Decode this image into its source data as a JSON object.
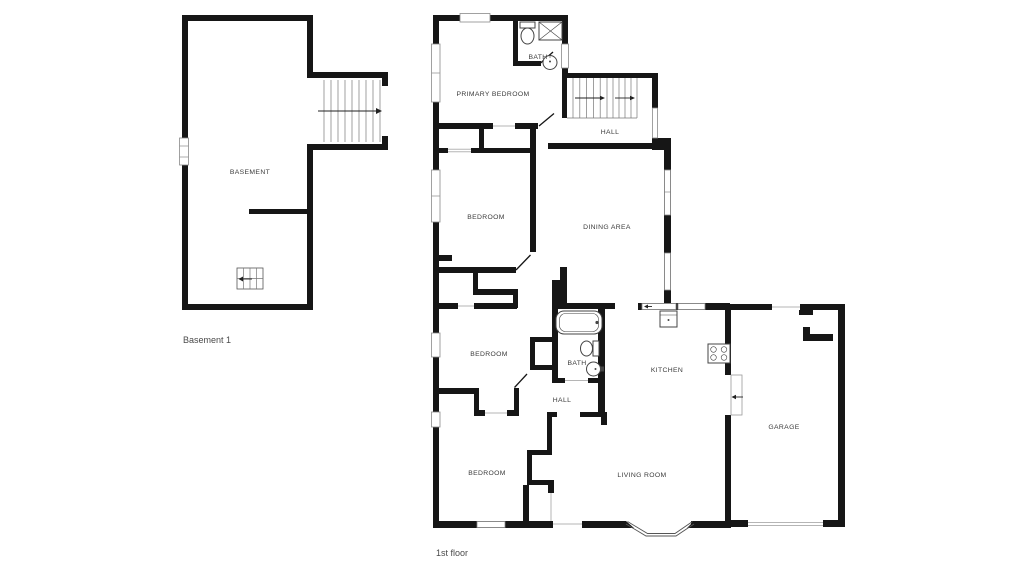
{
  "basement": {
    "label": "BASEMENT",
    "caption": "Basement 1"
  },
  "first_floor": {
    "caption": "1st floor",
    "rooms": [
      {
        "id": "primary-bedroom",
        "label": "PRIMARY BEDROOM"
      },
      {
        "id": "bath-upper",
        "label": "BATH"
      },
      {
        "id": "hall-upper",
        "label": "HALL"
      },
      {
        "id": "bedroom-mid",
        "label": "BEDROOM"
      },
      {
        "id": "dining-area",
        "label": "DINING AREA"
      },
      {
        "id": "bedroom-lower",
        "label": "BEDROOM"
      },
      {
        "id": "bath-lower",
        "label": "BATH"
      },
      {
        "id": "hall-lower",
        "label": "HALL"
      },
      {
        "id": "kitchen",
        "label": "KITCHEN"
      },
      {
        "id": "bedroom-bottom",
        "label": "BEDROOM"
      },
      {
        "id": "living-room",
        "label": "LIVING ROOM"
      },
      {
        "id": "garage",
        "label": "GARAGE"
      }
    ]
  },
  "colors": {
    "wall": "#161616",
    "room_label": "#3b3b3b",
    "caption": "#4a4a4a",
    "window_stroke": "#8a8a8a",
    "stair_line": "#777777"
  }
}
